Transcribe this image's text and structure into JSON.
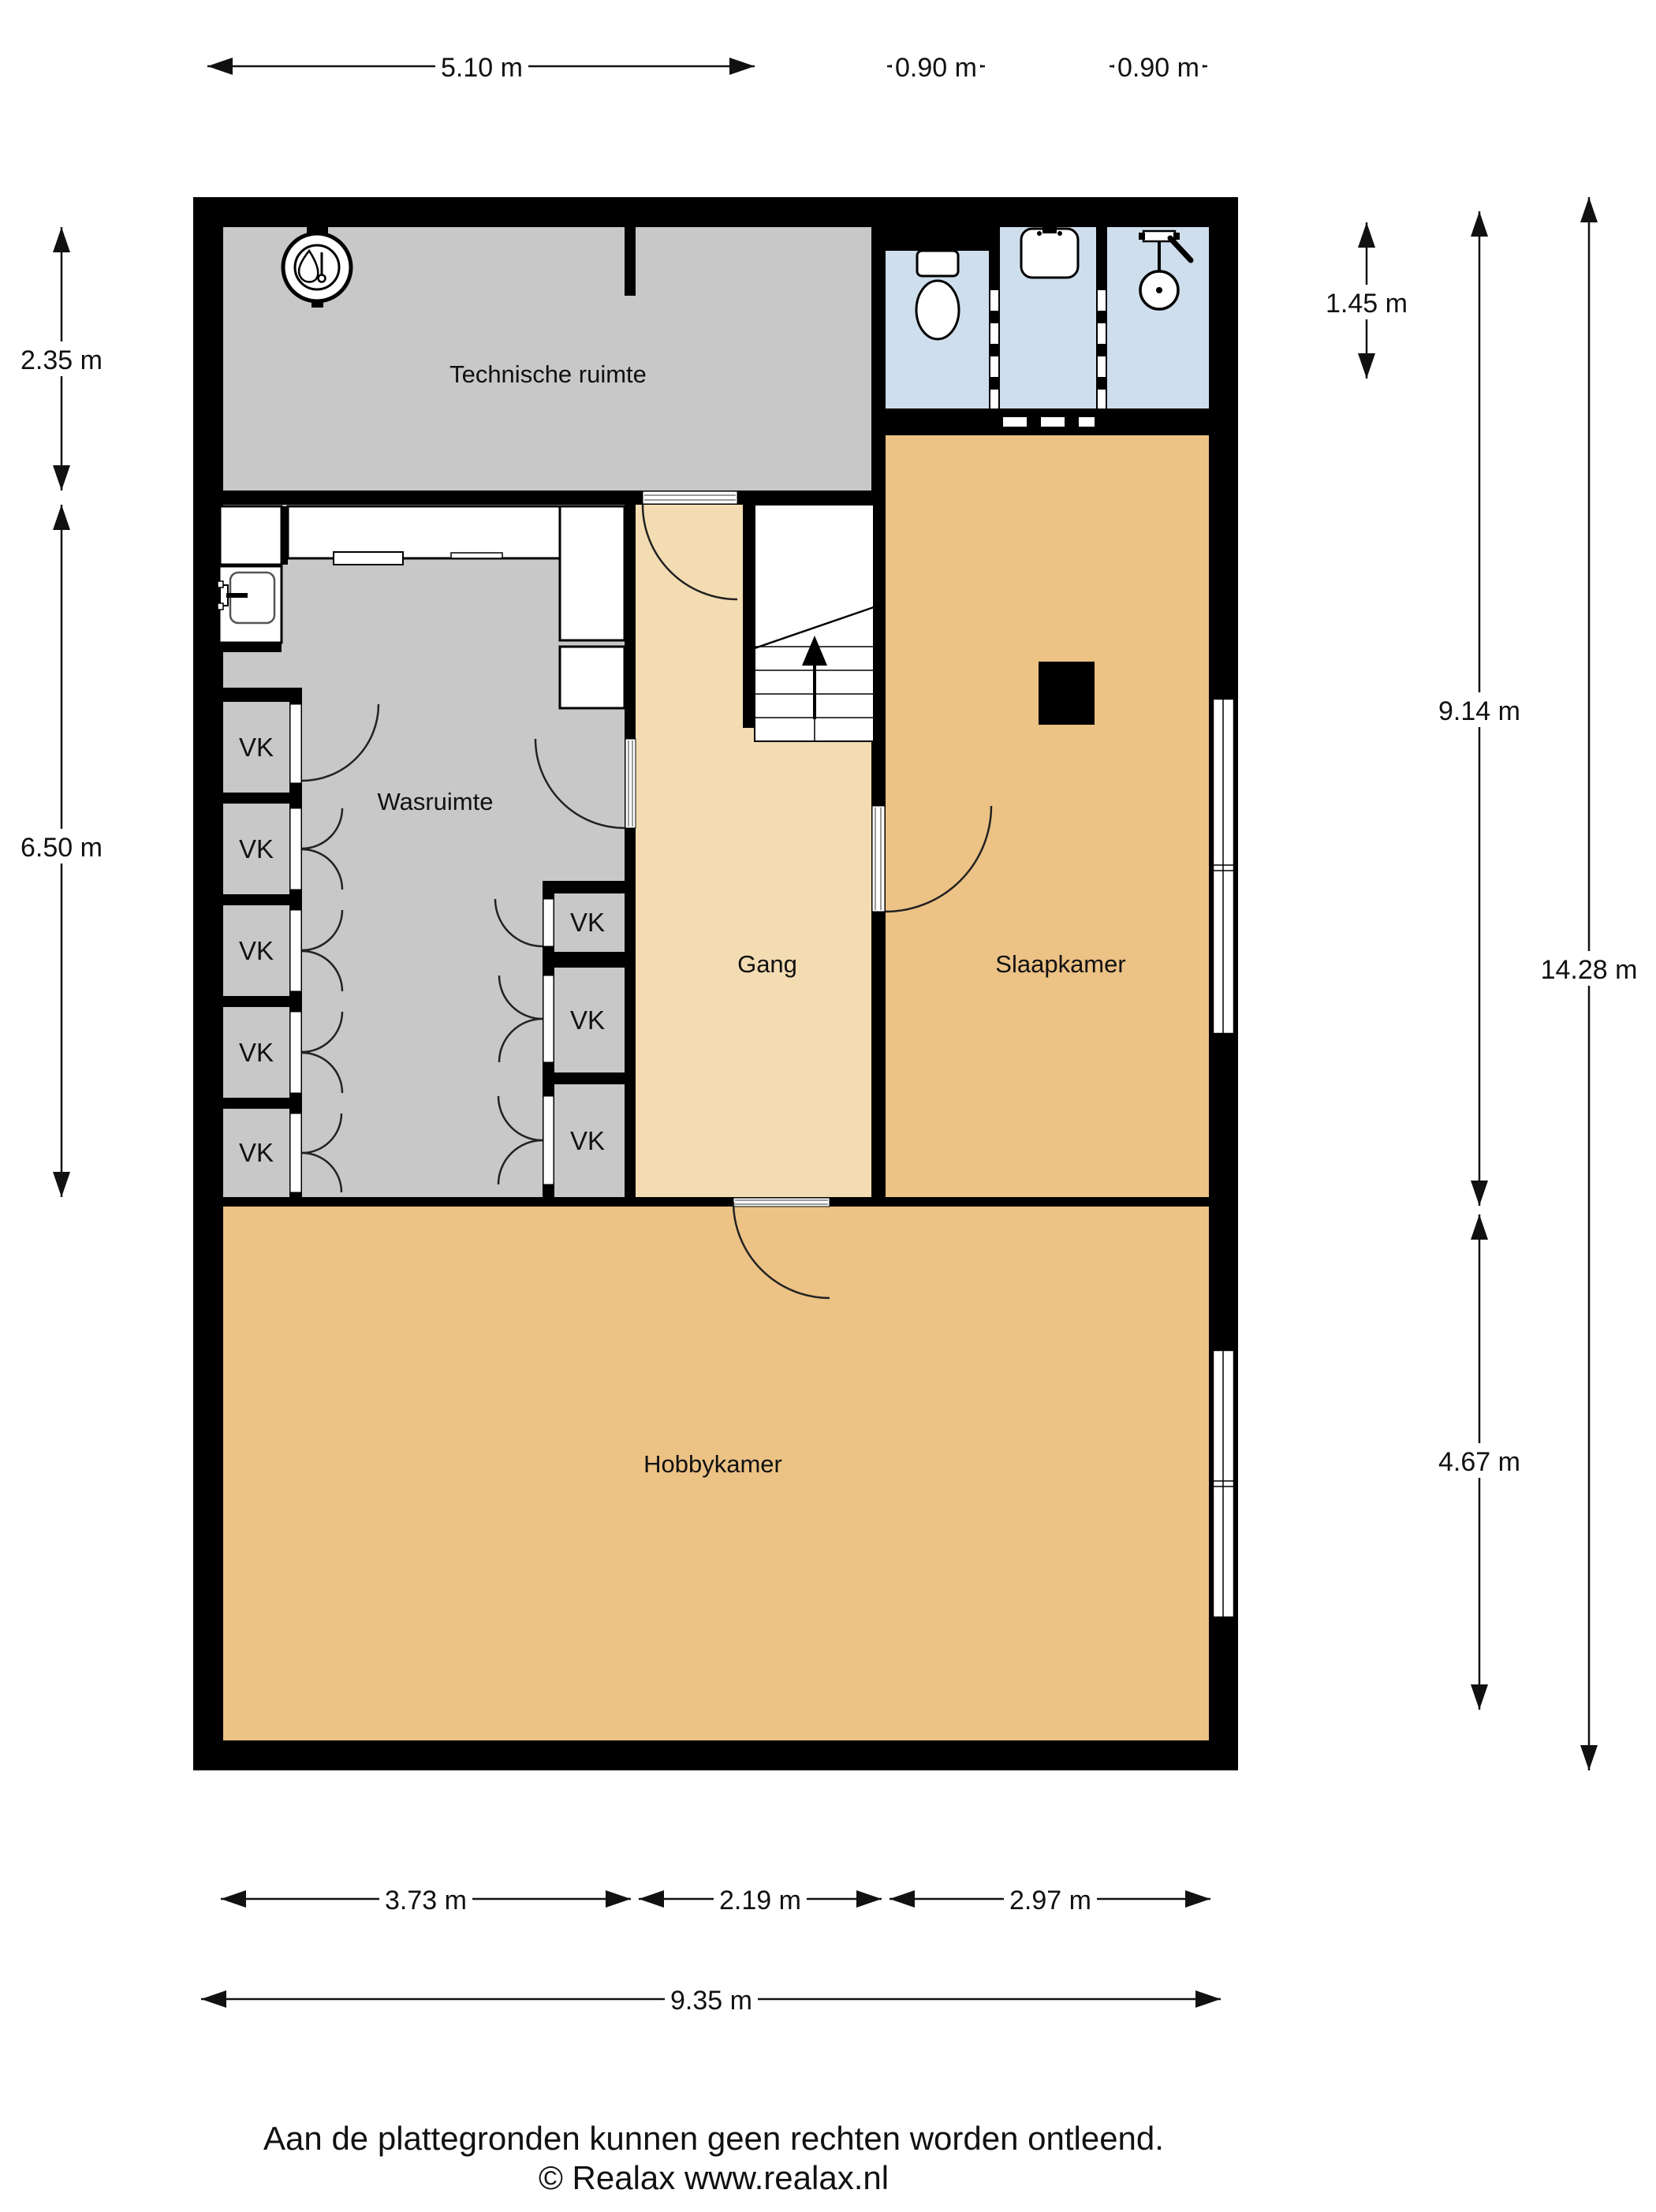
{
  "title": "Floor plan (plattegrond) - basement level",
  "rooms": {
    "technische_ruimte": "Technische ruimte",
    "wasruimte": "Wasruimte",
    "gang": "Gang",
    "slaapkamer": "Slaapkamer",
    "hobbykamer": "Hobbykamer",
    "closet": "VK"
  },
  "dims": {
    "top_main": "5.10 m",
    "top_wc": "0.90 m",
    "top_shower": "0.90 m",
    "left_technische": "2.35 m",
    "left_wasruimte": "6.50 m",
    "right_bathroom": "1.45 m",
    "right_slaapkamer": "9.14 m",
    "right_hobbykamer": "4.67 m",
    "right_total": "14.28 m",
    "bottom_wasruimte": "3.73 m",
    "bottom_gang": "2.19 m",
    "bottom_slaapkamer": "2.97 m",
    "bottom_total": "9.35 m"
  },
  "footer": {
    "disclaimer": "Aan de plattegronden kunnen geen rechten worden ontleend.",
    "copyright": "© Realax www.realax.nl"
  },
  "colors": {
    "wall": "#000000",
    "room_gray": "#c8c8c8",
    "room_tan": "#ecc285",
    "hallway_tan": "#f3dcb2",
    "bathroom_blue": "#cfdeed",
    "background": "#ffffff"
  }
}
